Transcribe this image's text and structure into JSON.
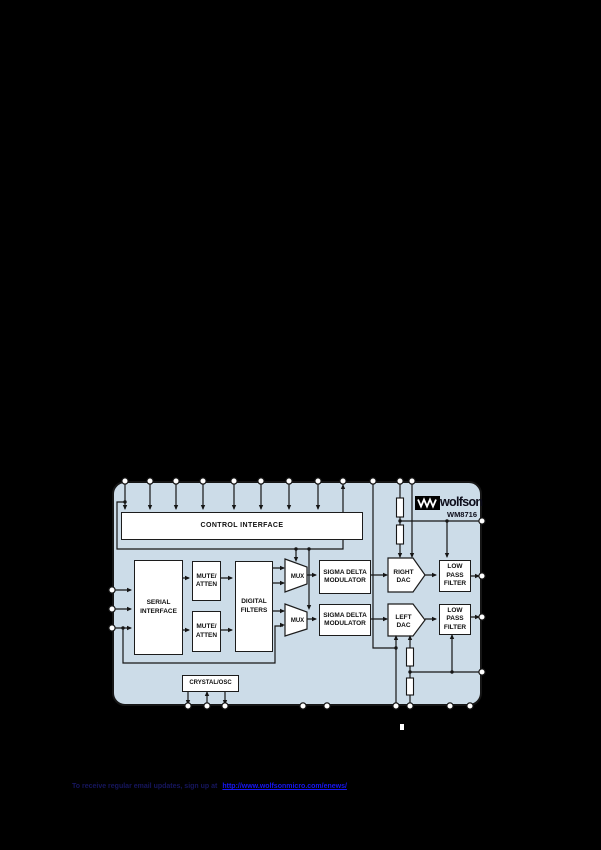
{
  "diagram": {
    "caption_mark": " ",
    "logo": {
      "brand": "wolfson",
      "part": "WM8716"
    },
    "blocks": {
      "control_interface": "CONTROL INTERFACE",
      "serial_interface": "SERIAL INTERFACE",
      "mute_atten_1": "MUTE/ ATTEN",
      "mute_atten_2": "MUTE/ ATTEN",
      "digital_filters": "DIGITAL FILTERS",
      "mux_1": "MUX",
      "mux_2": "MUX",
      "sigma_delta_1": "SIGMA DELTA MODULATOR",
      "sigma_delta_2": "SIGMA DELTA MODULATOR",
      "right_dac": "RIGHT DAC",
      "left_dac": "LEFT DAC",
      "lpf_1": "LOW PASS FILTER",
      "lpf_2": "LOW PASS FILTER",
      "crystal_osc": "CRYSTAL/OSC"
    },
    "colors": {
      "page_background": "#000000",
      "diagram_background": "#ccdce8",
      "block_fill": "#ffffff",
      "line": "#161616",
      "link_blue": "#1616f2",
      "footer_navy": "#16165e"
    }
  },
  "footer": {
    "prefix": "To receive regular email updates, sign up at",
    "link_text": "http://www.wolfsonmicro.com/enews/"
  }
}
